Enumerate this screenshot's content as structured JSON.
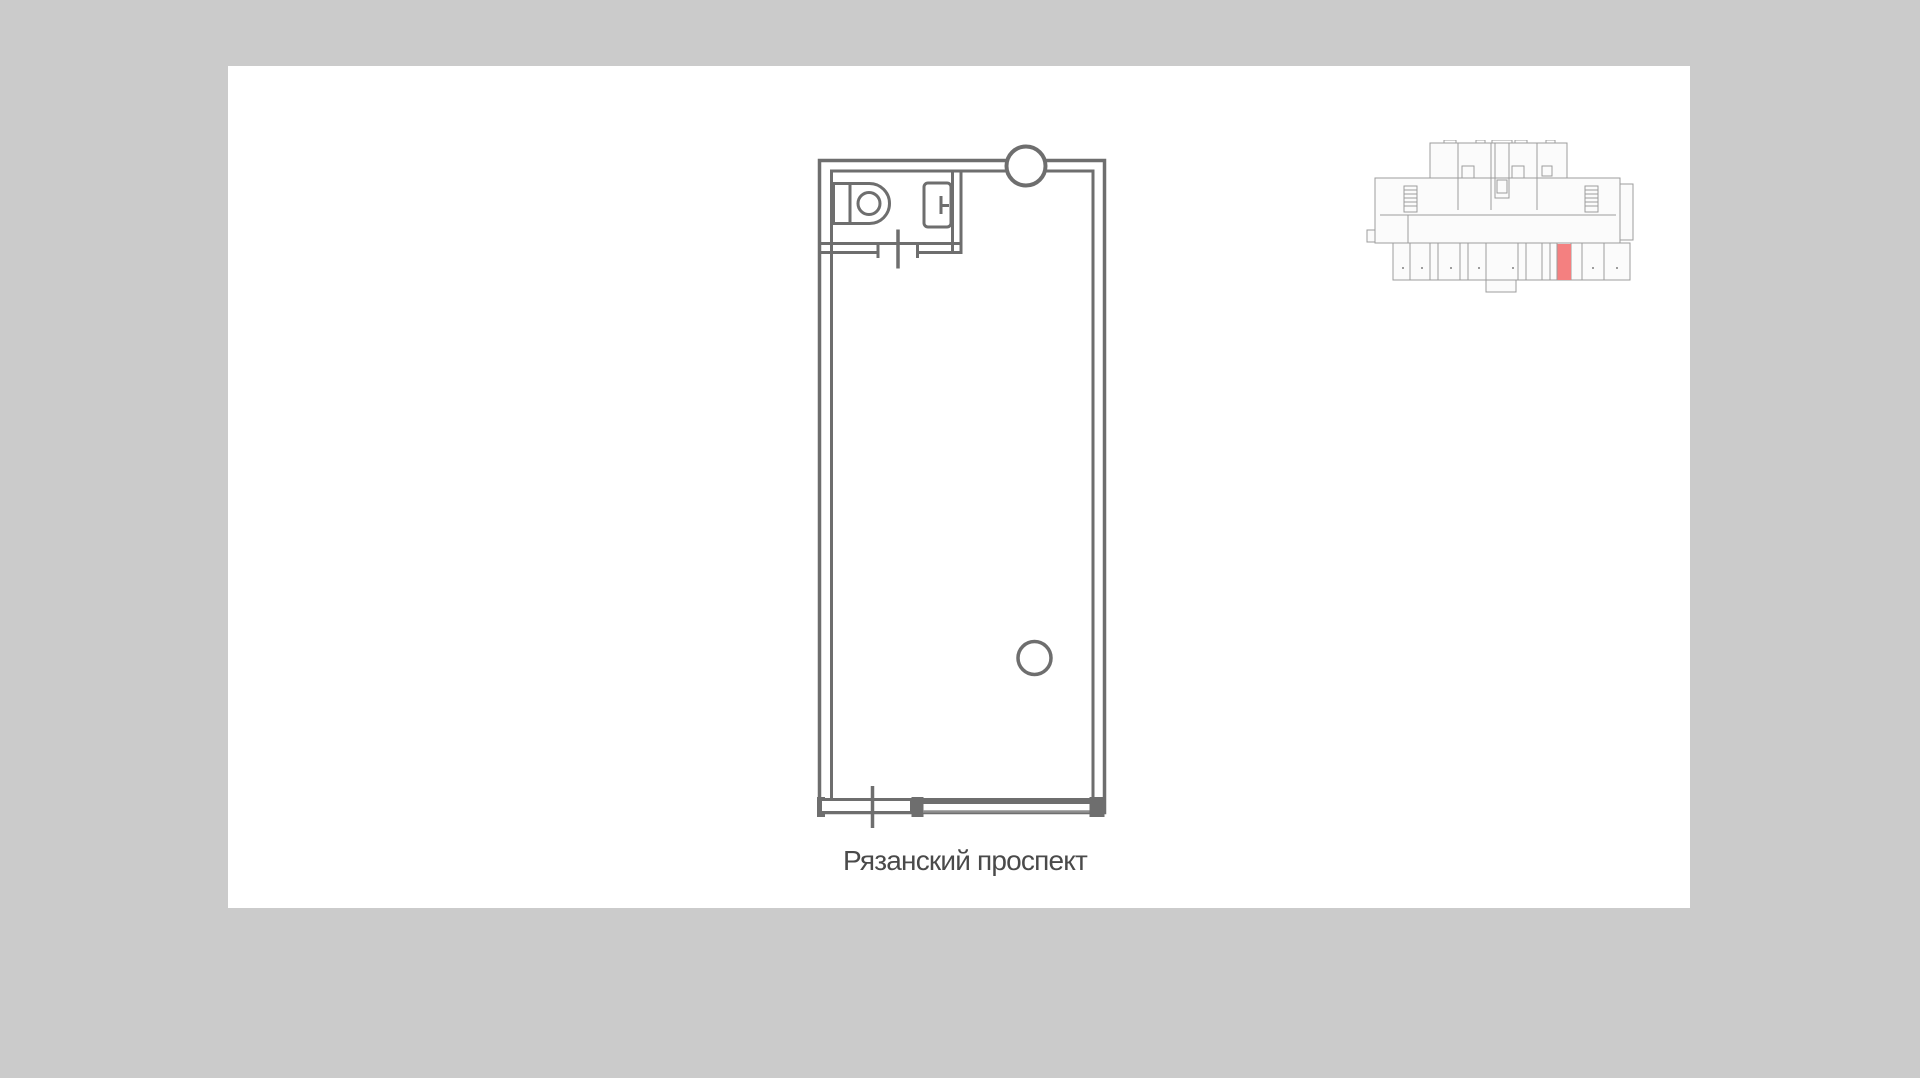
{
  "colors": {
    "canvas": "#ffffff",
    "dot": "#cbcbcb",
    "wall": "#6e6e6e",
    "wall-light": "#8f8f8f",
    "label": "#4a4a4a",
    "mini-stroke": "#9d9d9d",
    "mini-fill": "#fbfbfb",
    "highlight": "#f48080"
  },
  "floor_plan": {
    "street_label": "Рязанский проспект",
    "fixtures": [
      "toilet",
      "sink",
      "column",
      "interior-column",
      "bathroom-door",
      "entrance-door",
      "storefront-glazing"
    ]
  },
  "minimap": {
    "has_highlighted_unit": true
  }
}
